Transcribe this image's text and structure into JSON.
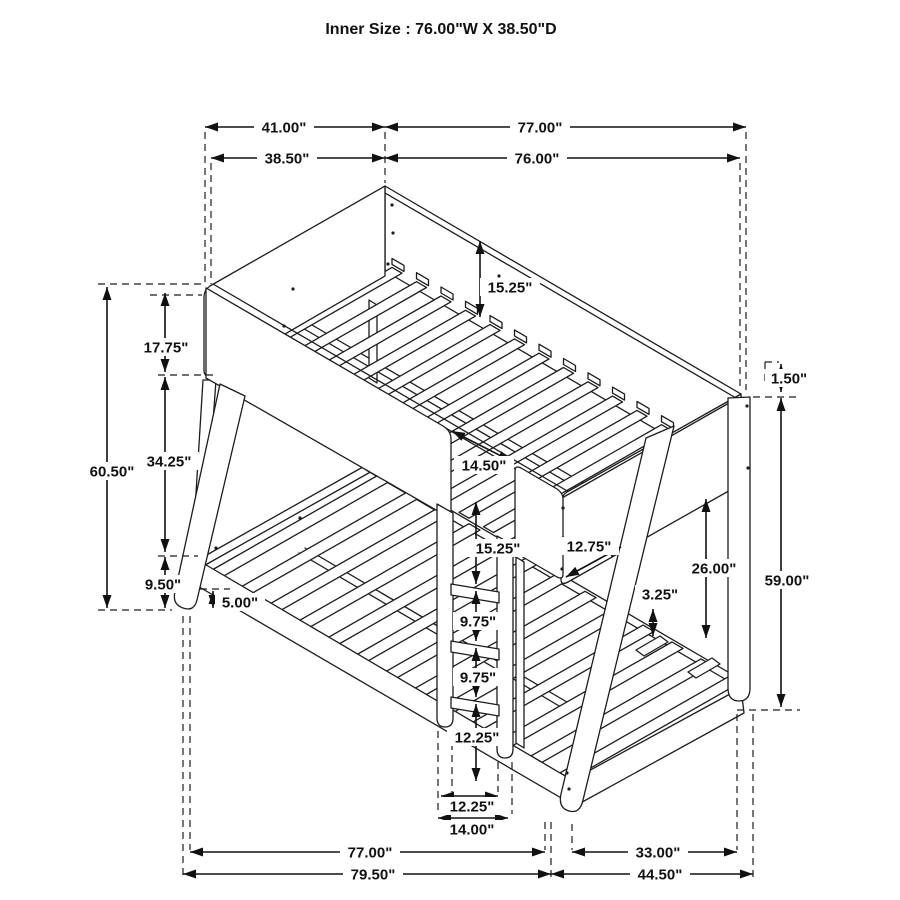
{
  "title": "Inner Size : 76.00\"W X  38.50\"D",
  "diagram": {
    "subject": "twin-over-full-bunk-bed-dimension-drawing",
    "ink_color": "#1c1c1c",
    "background_color": "#ffffff",
    "dimensions": [
      {
        "id": "top-overall-depth",
        "label": "41.00\"",
        "x": 284,
        "y": 127,
        "w": 60
      },
      {
        "id": "top-overall-length",
        "label": "77.00\"",
        "x": 540,
        "y": 127,
        "w": 60
      },
      {
        "id": "top-inner-depth",
        "label": "38.50\"",
        "x": 287,
        "y": 158,
        "w": 60
      },
      {
        "id": "top-inner-length",
        "label": "76.00\"",
        "x": 537,
        "y": 158,
        "w": 60
      },
      {
        "id": "headboard-rail-height",
        "label": "15.25\"",
        "x": 510,
        "y": 287,
        "w": 60
      },
      {
        "id": "left-upper-rail",
        "label": "17.75\"",
        "x": 166,
        "y": 347,
        "w": 60
      },
      {
        "id": "left-mid-gap",
        "label": "34.25\"",
        "x": 169,
        "y": 461,
        "w": 60
      },
      {
        "id": "left-total-height",
        "label": "60.50\"",
        "x": 112,
        "y": 471,
        "w": 60
      },
      {
        "id": "left-lower-rail",
        "label": "9.50\"",
        "x": 163,
        "y": 584,
        "w": 50
      },
      {
        "id": "left-foot-clearance",
        "label": "5.00\"",
        "x": 240,
        "y": 602,
        "w": 50
      },
      {
        "id": "ladder-opening",
        "label": "14.50\"",
        "x": 484,
        "y": 465,
        "w": 60
      },
      {
        "id": "ladder-top-step",
        "label": "15.25\"",
        "x": 498,
        "y": 548,
        "w": 60
      },
      {
        "id": "guard-rail-length",
        "label": "12.75\"",
        "x": 589,
        "y": 546,
        "w": 60
      },
      {
        "id": "footboard-height",
        "label": "26.00\"",
        "x": 714,
        "y": 568,
        "w": 60
      },
      {
        "id": "slat-clearance",
        "label": "3.25\"",
        "x": 660,
        "y": 594,
        "w": 50
      },
      {
        "id": "rail-lip",
        "label": "1.50\"",
        "x": 789,
        "y": 378,
        "w": 48
      },
      {
        "id": "right-total-height",
        "label": "59.00\"",
        "x": 787,
        "y": 580,
        "w": 60
      },
      {
        "id": "ladder-step-a",
        "label": "9.75\"",
        "x": 478,
        "y": 621,
        "w": 50
      },
      {
        "id": "ladder-step-b",
        "label": "9.75\"",
        "x": 478,
        "y": 677,
        "w": 50
      },
      {
        "id": "ladder-bottom-step",
        "label": "12.25\"",
        "x": 477,
        "y": 737,
        "w": 60
      },
      {
        "id": "ladder-width-inner",
        "label": "12.25\"",
        "x": 472,
        "y": 806,
        "w": 60
      },
      {
        "id": "ladder-width-outer",
        "label": "14.00\"",
        "x": 472,
        "y": 829,
        "w": 60
      },
      {
        "id": "bottom-inner-length",
        "label": "77.00\"",
        "x": 370,
        "y": 852,
        "w": 60
      },
      {
        "id": "bottom-outer-length",
        "label": "79.50\"",
        "x": 373,
        "y": 874,
        "w": 60
      },
      {
        "id": "bottom-foot-span",
        "label": "33.00\"",
        "x": 658,
        "y": 852,
        "w": 60
      },
      {
        "id": "bottom-outer-depth",
        "label": "44.50\"",
        "x": 660,
        "y": 874,
        "w": 60
      }
    ]
  }
}
